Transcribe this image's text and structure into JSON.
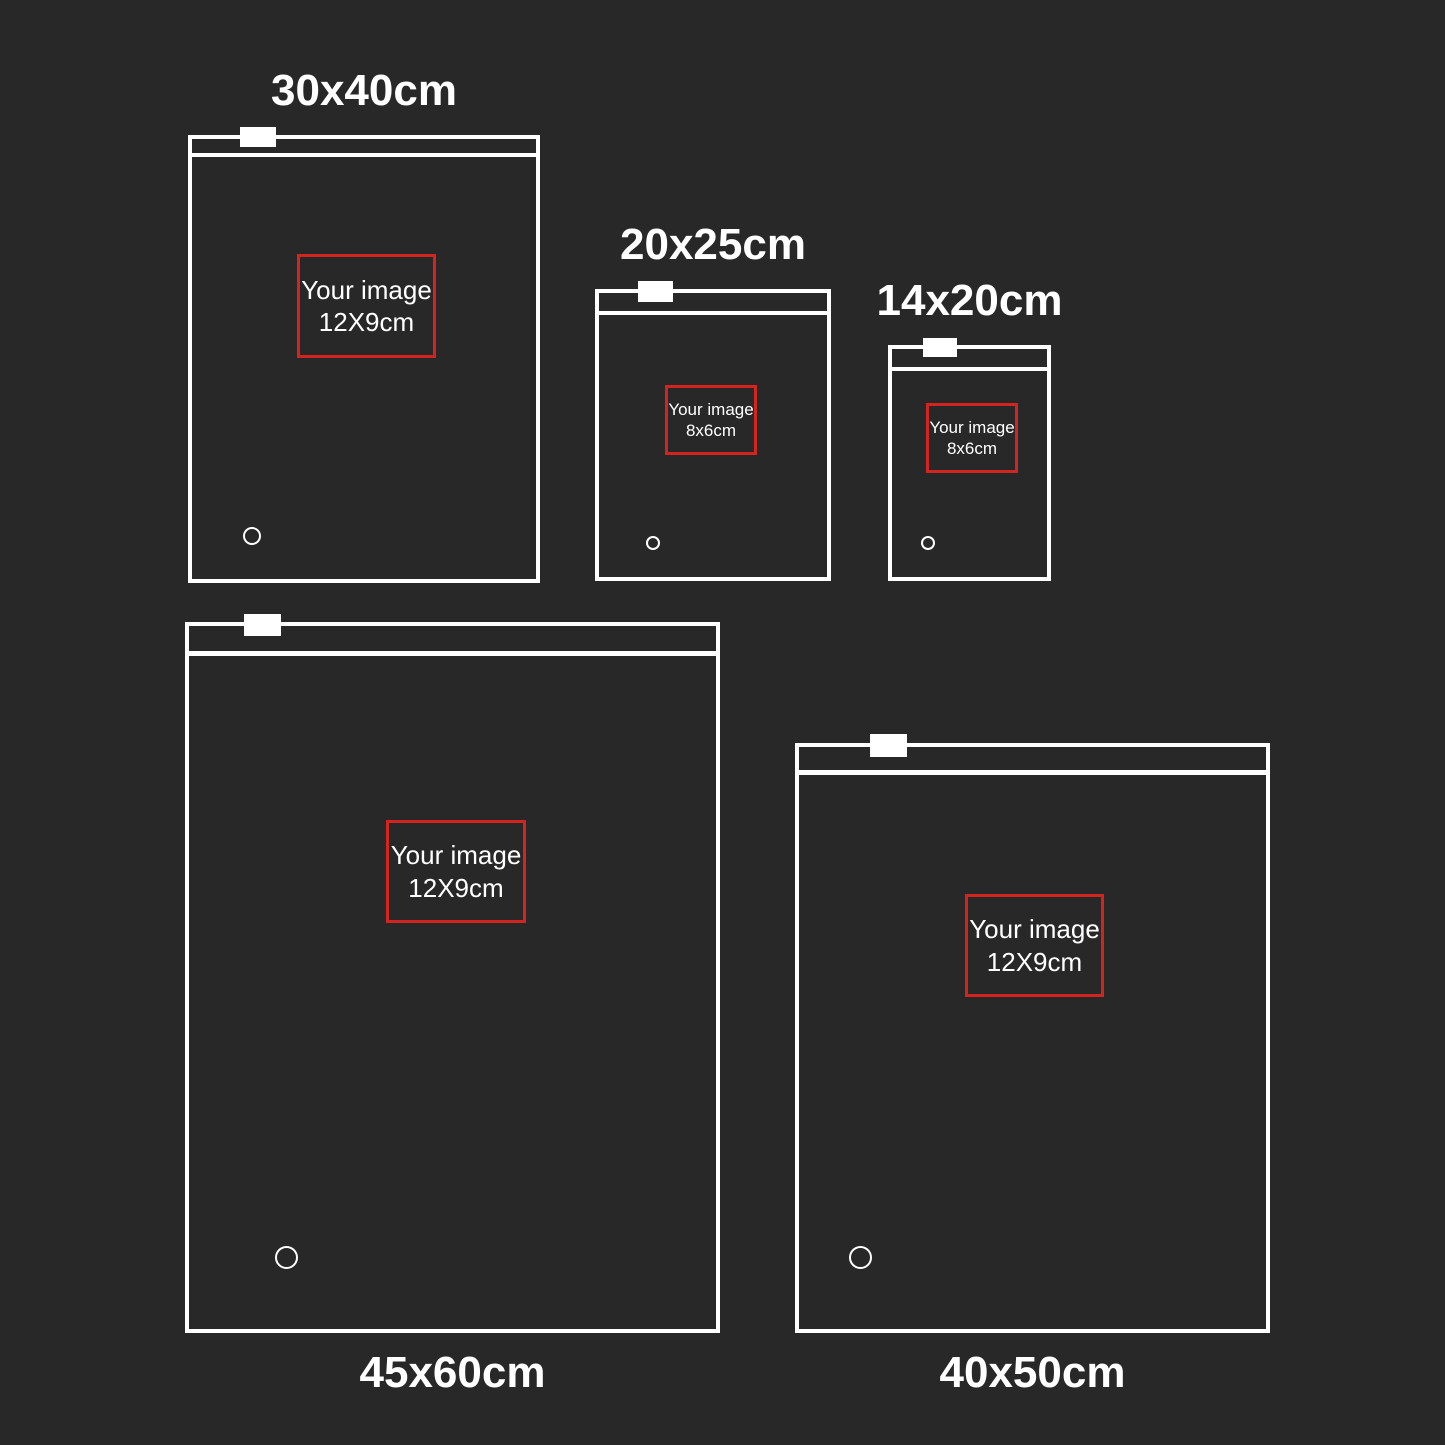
{
  "colors": {
    "background": "#282828",
    "outline": "#ffffff",
    "placeholder_border_red": "#d2251f"
  },
  "bags": [
    {
      "id": "bag-30x40cm",
      "size_label": "30x40cm",
      "label_position": "above",
      "image_box": {
        "line1": "Your image",
        "line2": "12X9cm"
      }
    },
    {
      "id": "bag-20x25cm",
      "size_label": "20x25cm",
      "label_position": "above",
      "image_box": {
        "line1": "Your image",
        "line2": "8x6cm"
      }
    },
    {
      "id": "bag-14x20cm",
      "size_label": "14x20cm",
      "label_position": "above",
      "image_box": {
        "line1": "Your image",
        "line2": "8x6cm"
      }
    },
    {
      "id": "bag-45x60cm",
      "size_label": "45x60cm",
      "label_position": "below",
      "image_box": {
        "line1": "Your image",
        "line2": "12X9cm"
      }
    },
    {
      "id": "bag-40x50cm",
      "size_label": "40x50cm",
      "label_position": "below",
      "image_box": {
        "line1": "Your image",
        "line2": "12X9cm"
      }
    }
  ]
}
